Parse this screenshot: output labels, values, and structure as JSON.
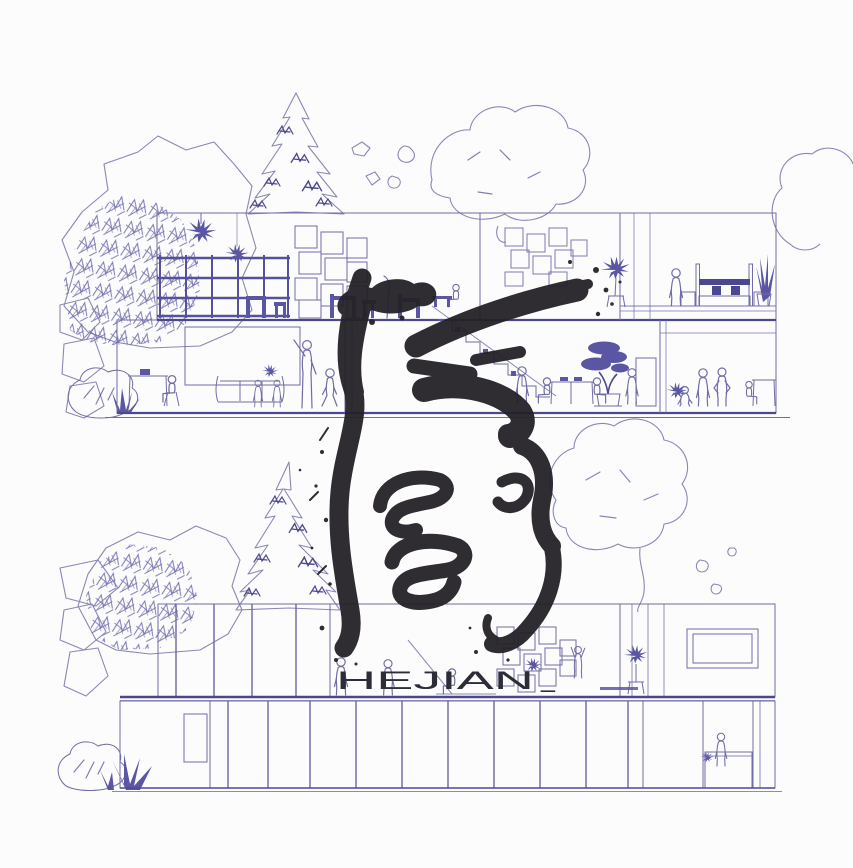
{
  "artwork": {
    "wordmark": "HEJIAN",
    "trailing_underscore": "_",
    "ink_character": "间",
    "drawing_type": "architectural section and elevation line drawing with calligraphic ink character overlay"
  },
  "palette": {
    "background": "#fcfcfc",
    "line_light": "#8a87b5",
    "line": "#716da6",
    "line_dark": "#4c4890",
    "plant_fill": "#5b56a4",
    "ink_black": "#232126",
    "wordmark_color": "#2d2d37"
  },
  "upper_section": {
    "floors": 2,
    "rooms_left_to_right": [
      "study with gridded screen and shelving",
      "meeting room with presentation board",
      "stair hall with tables and bonsai",
      "bedroom with bed and plants"
    ]
  },
  "lower_section": {
    "bands": 2,
    "features": [
      "vertical slatted facade",
      "framed picture window",
      "box shelving with climbing figure",
      "reception counter with attendant",
      "narrow doorway"
    ]
  },
  "vegetation": [
    "broadleaf tree",
    "pine tree",
    "round canopy tree",
    "shrub",
    "grass tuft",
    "bonsai",
    "hanging plants",
    "potted plants"
  ]
}
